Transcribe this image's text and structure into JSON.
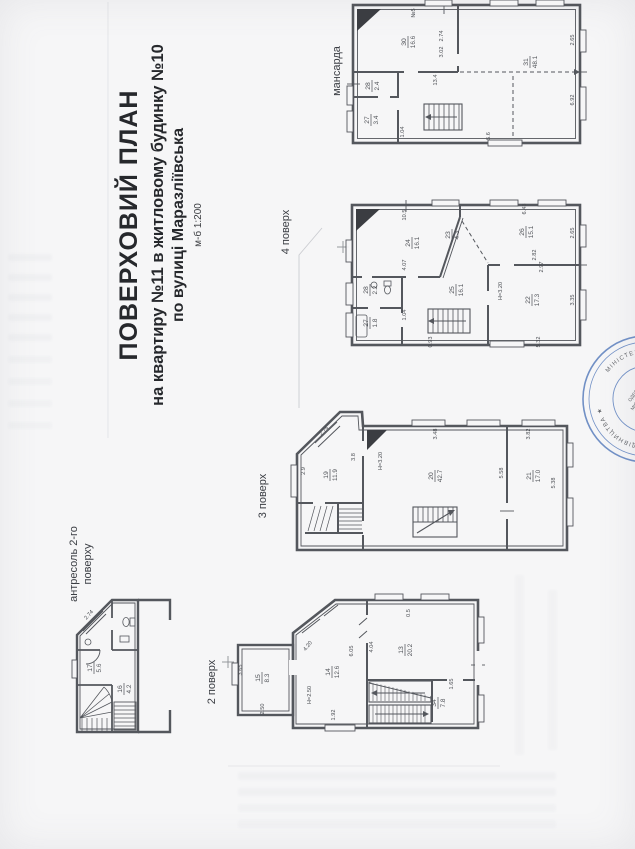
{
  "title": {
    "line1": "ПОВЕРХОВИЙ ПЛАН",
    "line2": "на квартиру №11 в житловому будинку №10",
    "line3": "по вулиці Маразліївська",
    "scale": "м-б 1:200"
  },
  "floors": {
    "mansard": {
      "label": "мансарда",
      "rooms": [
        {
          "num": "30",
          "area": "16.6",
          "x": 68,
          "y": 42
        },
        {
          "num": "28",
          "area": "2.4",
          "x": 32,
          "y": 86
        },
        {
          "num": "27",
          "area": "3.4",
          "x": 31,
          "y": 120
        },
        {
          "num": "31",
          "area": "48.1",
          "x": 190,
          "y": 62
        }
      ],
      "dims": [
        {
          "t": "2.74",
          "x": 103,
          "y": 36
        },
        {
          "t": "3.02",
          "x": 103,
          "y": 52
        },
        {
          "t": "№5",
          "x": 75,
          "y": 13
        },
        {
          "t": "13.4",
          "x": 97,
          "y": 80
        },
        {
          "t": "6.92",
          "x": 234,
          "y": 100
        },
        {
          "t": "5.6",
          "x": 150,
          "y": 136
        },
        {
          "t": "2.65",
          "x": 234,
          "y": 40
        },
        {
          "t": "1.04",
          "x": 64,
          "y": 132
        }
      ]
    },
    "floor4": {
      "label": "4 поверх",
      "rooms": [
        {
          "num": "24",
          "area": "16.1",
          "x": 72,
          "y": 48
        },
        {
          "num": "23",
          "area": "4.3",
          "x": 112,
          "y": 40
        },
        {
          "num": "26",
          "area": "15.1",
          "x": 186,
          "y": 37
        },
        {
          "num": "25",
          "area": "16.1",
          "x": 116,
          "y": 95
        },
        {
          "num": "22",
          "area": "17.3",
          "x": 192,
          "y": 105
        },
        {
          "num": "28",
          "area": "2.2",
          "x": 30,
          "y": 95
        },
        {
          "num": "27",
          "area": "1.8",
          "x": 30,
          "y": 128
        }
      ],
      "dims": [
        {
          "t": "10.5",
          "x": 66,
          "y": 20
        },
        {
          "t": "6.43",
          "x": 186,
          "y": 14
        },
        {
          "t": "2.65",
          "x": 234,
          "y": 38
        },
        {
          "t": "2.82",
          "x": 196,
          "y": 60
        },
        {
          "t": "2.97",
          "x": 203,
          "y": 72
        },
        {
          "t": "3.35",
          "x": 234,
          "y": 105
        },
        {
          "t": "5.32",
          "x": 200,
          "y": 147
        },
        {
          "t": "Н=3.20",
          "x": 162,
          "y": 96
        },
        {
          "t": "4.07",
          "x": 66,
          "y": 70
        },
        {
          "t": "1.04",
          "x": 66,
          "y": 120
        },
        {
          "t": "0.93",
          "x": 92,
          "y": 147
        }
      ]
    },
    "floor3": {
      "label": "3 поверх",
      "rooms": [
        {
          "num": "19",
          "area": "11.9",
          "x": 45,
          "y": 72
        },
        {
          "num": "20",
          "area": "42.7",
          "x": 150,
          "y": 73
        },
        {
          "num": "21",
          "area": "17.0",
          "x": 248,
          "y": 73
        }
      ],
      "dims": [
        {
          "t": "2.9",
          "x": 20,
          "y": 68
        },
        {
          "t": "3.8",
          "x": 70,
          "y": 54
        },
        {
          "t": "Н=3.20",
          "x": 97,
          "y": 58
        },
        {
          "t": "3.48",
          "x": 152,
          "y": 31
        },
        {
          "t": "3.82",
          "x": 245,
          "y": 31
        },
        {
          "t": "5.58",
          "x": 218,
          "y": 70
        },
        {
          "t": "5.38",
          "x": 270,
          "y": 80
        },
        {
          "t": "2.74",
          "x": 40,
          "y": 29,
          "rot": -45
        }
      ]
    },
    "floor2": {
      "label": "2 поверх",
      "rooms": [
        {
          "num": "15",
          "area": "8.3",
          "x": 37,
          "y": 93
        },
        {
          "num": "14",
          "area": "12.6",
          "x": 107,
          "y": 87
        },
        {
          "num": "13",
          "area": "20.2",
          "x": 180,
          "y": 65
        },
        {
          "num": "34",
          "area": "7.8",
          "x": 213,
          "y": 118
        }
      ],
      "dims": [
        {
          "t": "3.65",
          "x": 17,
          "y": 85
        },
        {
          "t": "2.50",
          "x": 39,
          "y": 124
        },
        {
          "t": "4.20",
          "x": 84,
          "y": 62,
          "rot": -52
        },
        {
          "t": "6.05",
          "x": 128,
          "y": 66
        },
        {
          "t": "Н=2.50",
          "x": 86,
          "y": 110
        },
        {
          "t": "1.92",
          "x": 110,
          "y": 130
        },
        {
          "t": "4.04",
          "x": 148,
          "y": 62
        },
        {
          "t": "0.5",
          "x": 185,
          "y": 28
        },
        {
          "t": "1.65",
          "x": 228,
          "y": 99
        }
      ]
    },
    "mezzanine": {
      "label_line1": "антресоль 2-го",
      "label_line2": "поверху",
      "rooms": [
        {
          "num": "17",
          "area": "5.6",
          "x": 34,
          "y": 78
        },
        {
          "num": "16",
          "area": "4.2",
          "x": 64,
          "y": 99
        }
      ],
      "dims": [
        {
          "t": "2.74",
          "x": 30,
          "y": 26,
          "rot": -48
        }
      ]
    }
  },
  "stamp": {
    "ring_text": "МІНІСТЕРСТВО РЕГІОНАЛЬНОГО РОЗВИТКУ ТА БУДІВНИЦТВА ★",
    "country": "УКРАЇНА",
    "center_lines": [
      "ОДЕСЬКЕ",
      "МІСЬКЕ БЮРО",
      "ТЕХНІЧНОЇ",
      "ІНВЕНТАРИЗАЦІЇ"
    ]
  },
  "colors": {
    "ink": "#3d4046",
    "stamp": "#4d74b8",
    "paper": "#f6f6f7"
  }
}
